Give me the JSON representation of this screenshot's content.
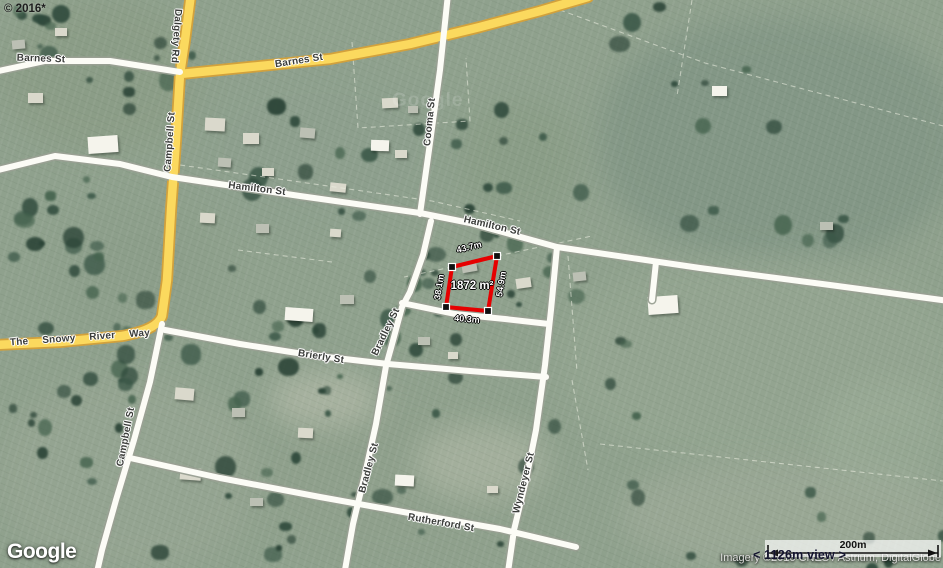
{
  "overlay": {
    "copyright": "© 2016*",
    "watermark": "Google"
  },
  "colors": {
    "road_yellow": "#fbd95e",
    "measure_red": "#e60000"
  },
  "streets": {
    "barnes_west": "Barnes St",
    "barnes_east": "Barnes St",
    "dalgety": "Dalgety Rd",
    "campbell_north": "Campbell St",
    "campbell_south": "Campbell St",
    "hamilton_west": "Hamilton St",
    "hamilton_east": "Hamilton St",
    "cooma": "Cooma St",
    "snowy": "The Snowy River Way",
    "brierly": "Brierly St",
    "bradley_north": "Bradley St",
    "bradley_south": "Bradley St",
    "rutherford": "Rutherford St",
    "wyndeyer": "Wyndeyer St"
  },
  "measurement": {
    "area": "1872 m²",
    "outline_color": "#e60000",
    "sides": {
      "top": "43.7m",
      "left": "38.1m",
      "right": "54.9m",
      "bottom": "40.3m"
    }
  },
  "logo": {
    "text": "Google"
  },
  "attribution": {
    "imagery": "Imagery ©2016 CNES / Astrium, DigitalGlobe",
    "view": "< 1126m view >"
  },
  "scale_bar": {
    "label": "200m"
  }
}
